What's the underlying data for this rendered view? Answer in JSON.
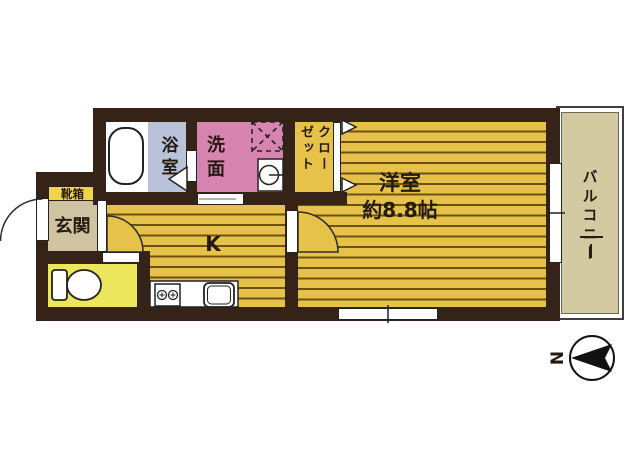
{
  "floor_plan": {
    "bathroom": {
      "label": "浴室"
    },
    "washroom": {
      "label": "洗面"
    },
    "closet": {
      "label": "クローゼット"
    },
    "shoe_box": {
      "label": "靴箱"
    },
    "entrance": {
      "label": "玄関"
    },
    "kitchen": {
      "label": "K"
    },
    "western_room": {
      "label": "洋室",
      "size": "約8.8帖"
    },
    "balcony": {
      "label": "バルコニー"
    },
    "compass": {
      "north_label": "N"
    },
    "colors": {
      "wall": "#362318",
      "flooring": "#e7c24a",
      "flooring_stripe": "#6b5212",
      "bathroom": "#b8c2d8",
      "washroom": "#d884b0",
      "toilet": "#ebe65c",
      "entrance": "#cfc3a2",
      "shoe_box": "#f0d44e",
      "balcony": "#d4caa2"
    }
  }
}
